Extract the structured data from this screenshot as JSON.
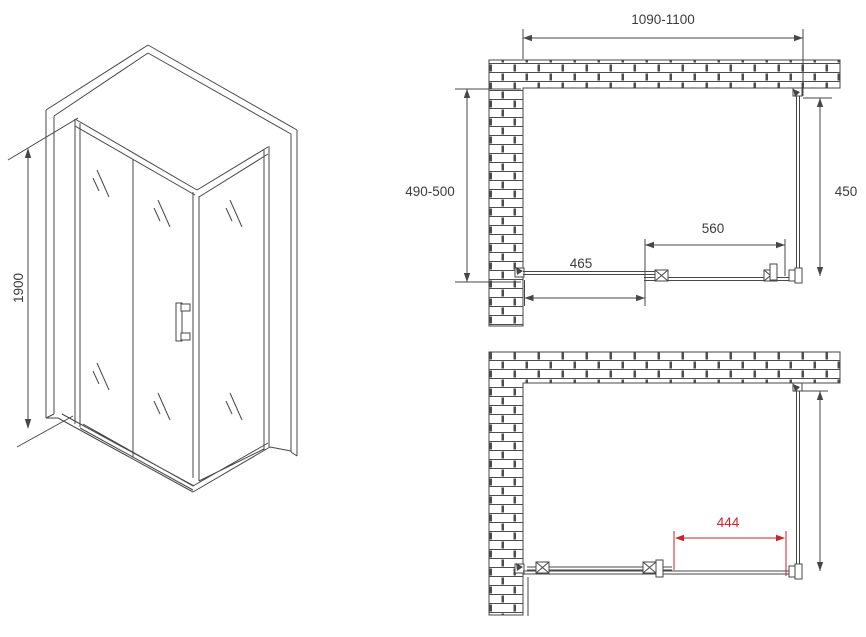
{
  "colors": {
    "line": "#474747",
    "text": "#3c3c3c",
    "accent_red": "#cc2229"
  },
  "isometric_view": {
    "height_dim": "1900"
  },
  "plan_view_top": {
    "width_dim": "1090-1100",
    "depth_dim": "490-500",
    "side_panel_dim": "450",
    "door_dim": "560",
    "fixed_panel_dim": "465"
  },
  "plan_view_bottom": {
    "opening_dim": "444"
  }
}
